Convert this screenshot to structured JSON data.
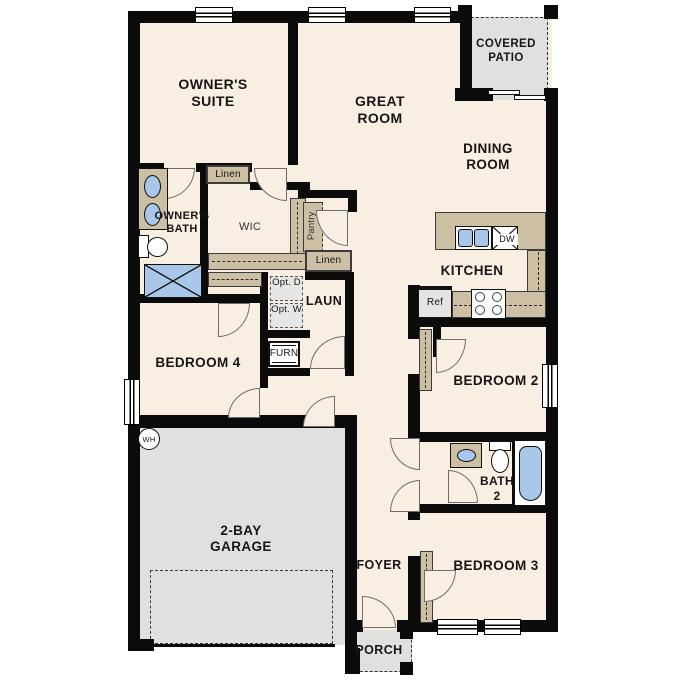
{
  "plan": {
    "title": "single story floor plan",
    "rooms": {
      "owners_suite": "OWNER'S SUITE",
      "great_room": "GREAT ROOM",
      "dining_room": "DINING ROOM",
      "covered_patio": "COVERED PATIO",
      "owners_bath": "OWNER'S BATH",
      "wic": "WIC",
      "laundry": "LAUN",
      "kitchen": "KITCHEN",
      "bedroom2": "BEDROOM 2",
      "bedroom3": "BEDROOM 3",
      "bedroom4": "BEDROOM 4",
      "bath2": "BATH 2",
      "foyer": "FOYER",
      "porch": "PORCH",
      "garage": "2-BAY GARAGE"
    },
    "closets": {
      "linen": "Linen",
      "pantry": "Pantry"
    },
    "fixtures": {
      "opt_dryer": "Opt. D",
      "opt_washer": "Opt. W",
      "furnace": "FURN",
      "refrigerator": "Ref",
      "dishwasher": "DW",
      "water_heater": "WH"
    },
    "colors": {
      "floor_cream": "#f8efe2",
      "counter_tan": "#cdbfa4",
      "garage_gray": "#e0e0de",
      "fixture_blue": "#a9c7e8",
      "wall_black": "#0b0b0b"
    }
  }
}
